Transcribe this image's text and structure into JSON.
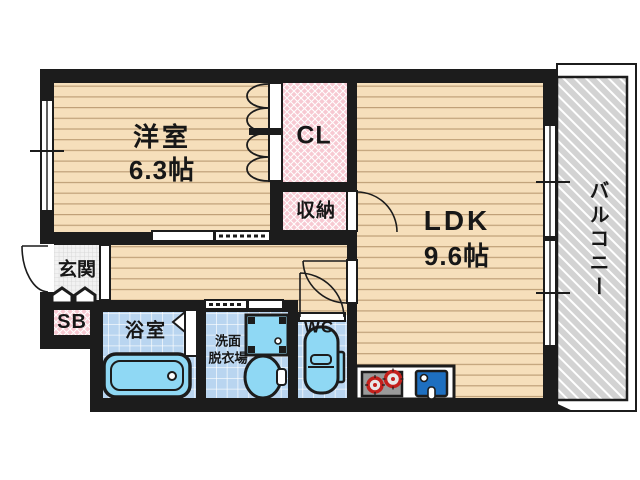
{
  "rooms": {
    "western": {
      "name": "洋室",
      "size": "6.3帖"
    },
    "closet": {
      "label": "CL"
    },
    "storage": {
      "label": "収納"
    },
    "ldk": {
      "name": "LDK",
      "size": "9.6帖"
    },
    "balcony": {
      "label": "バルコニー"
    },
    "entrance": {
      "label": "玄関"
    },
    "shoe_box": {
      "label": "SB"
    },
    "bathroom": {
      "label": "浴室"
    },
    "washroom": {
      "label_line1": "洗面",
      "label_line2": "脱衣場"
    },
    "toilet": {
      "label": "WC"
    }
  },
  "icons": {
    "bathtub": "bathtub-icon",
    "washing_machine_pan": "washing-machine-pan-icon",
    "wash_basin": "wash-basin-icon",
    "toilet_bowl": "toilet-icon",
    "gas_stove": "gas-stove-icon",
    "kitchen_sink": "kitchen-sink-icon",
    "entrance_steps": "entrance-step-icon"
  },
  "colors": {
    "wall": "#1c1c1c",
    "floor": "#f6dfbb",
    "floor_line": "#bfa078",
    "closet_pink": "#f7c9d2",
    "tile_blue": "#b9d5f0",
    "fixture_blue": "#8fd8f4",
    "sink_blue": "#1e6fc0",
    "stove_gray": "#9a9a9a",
    "burner_red": "#c4201c",
    "balcony_gray": "#d3d3d3",
    "entrance_tile": "#f2f2f2"
  }
}
